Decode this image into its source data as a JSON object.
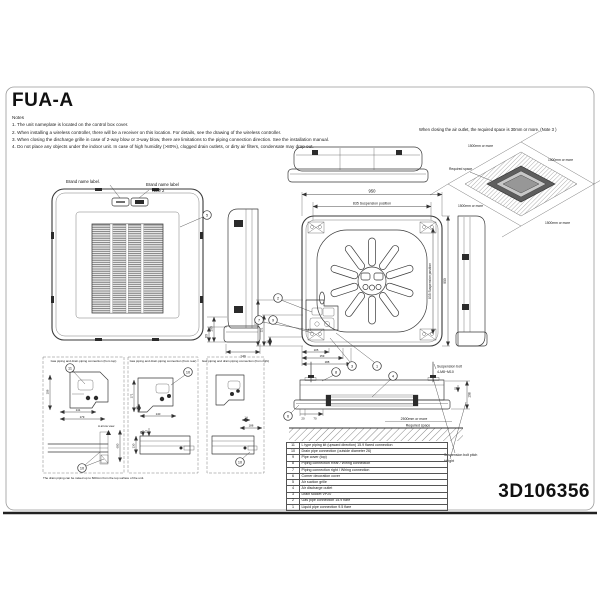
{
  "title": "FUA-A",
  "notes": {
    "heading": "Notes",
    "items": [
      "1. The unit nameplate is located on the control box cover.",
      "2. When installing a wireless controller, there will be a receiver on this location. For details, see the drawing of the wireless controller.",
      "3. When closing the discharge grille in case of 2-way blow or 3-way blow, there are limitations to the piping connection direction. See the installation manual.",
      "4. Do not place any objects under the indoor unit. In case of high humidity (>80%), clogged drain outlets, or dirty air filters, condensate may drop out."
    ]
  },
  "required_space": {
    "note": "When closing the air outlet, the required space is 30mm or more.  (Note 3 )",
    "label": "Required space",
    "clearance_top_left": "1500mm  or more",
    "clearance_top_right": "1500mm  or more",
    "clearance_bottom_left": "1500mm  or more",
    "clearance_bottom_right": "1500mm  or more"
  },
  "front_view": {
    "brand_label_1": "Brand name label.",
    "brand_label_2": "Brand name label",
    "brand_label_2_note": "Note 2",
    "callout_5": "5"
  },
  "side_view": {
    "dim_100": "100",
    "dim_60": "60",
    "dim_140": "140"
  },
  "top_view": {
    "dim_width": "950",
    "dim_suspension_top": "835 Suspension position",
    "dim_suspension_right": "835 Suspension position",
    "dim_height": "950",
    "dim_left_1": "178",
    "dim_left_2": "121",
    "dim_left_3": "36",
    "dim_bottom_1": "105",
    "dim_bottom_2": "159",
    "dim_bottom_3": "188",
    "callout_2": "2",
    "callout_7": "7",
    "callout_9": "9",
    "callout_3": "3",
    "callout_1": "1"
  },
  "details": {
    "box1": {
      "title": "Gas piping and drain piping connection (from top)",
      "callout_11": "11",
      "callout_10": "10",
      "dim_108": "108",
      "dim_141": "141",
      "dim_179": "179",
      "arrow_view": "A arrow view",
      "dim_600": "600"
    },
    "box2": {
      "title": "Gas piping and drain piping connection (from rear)",
      "callout_10": "10",
      "dim_171": "171",
      "dim_28": "28",
      "dim_140": "140",
      "dim_130": "130",
      "dim_25": "25",
      "dim_57": "57"
    },
    "box3": {
      "title": "Gas piping and drain piping connection (from right)",
      "callout_10": "10",
      "dim_14": "14",
      "dim_188": "188"
    },
    "note": "The drain piping can be raised up to 600mm from the top surface of the unit."
  },
  "installation_view": {
    "suspension_bolt_label": "Suspension bolt",
    "suspension_bolt_spec": "4-M8~M10",
    "dim_198": "198",
    "dim_25": "25",
    "dim_20": "20",
    "dim_70": "70",
    "clearance": "2500mm  or more",
    "required_space": "Required space",
    "bolt_pitch_label": "Suspension bolt pitch",
    "height_label": "Height",
    "callout_8": "8",
    "callout_4": "4",
    "callout_6": "6"
  },
  "parts_table": {
    "rows": [
      {
        "num": "11",
        "desc": "L type piping kit (upward direction) 15.9 flared connection"
      },
      {
        "num": "10",
        "desc": "Drain pipe connection (outside diameter 26)"
      },
      {
        "num": "9",
        "desc": "Pipe cover (top)"
      },
      {
        "num": "8",
        "desc": "Piping connection Rear / Wiring connection"
      },
      {
        "num": "7",
        "desc": "Piping connection right / Wiring connection"
      },
      {
        "num": "6",
        "desc": "Corner decoration cover"
      },
      {
        "num": "5",
        "desc": "Air suction grille"
      },
      {
        "num": "4",
        "desc": "Air discharge outlet"
      },
      {
        "num": "3",
        "desc": "Drain socket VP20"
      },
      {
        "num": "2",
        "desc": "Gas pipe connection 15.9 flare"
      },
      {
        "num": "1",
        "desc": "Liquid pipe connection 9.5 flare"
      }
    ]
  },
  "drawing_number": "3D106356"
}
